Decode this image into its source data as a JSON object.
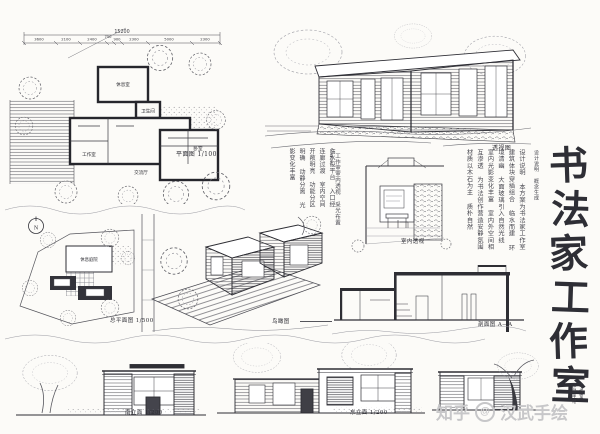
{
  "colors": {
    "paper": "#fcfbf8",
    "ink": "#2b2b30",
    "pencil": "#6b6b72",
    "watermark": "#c7c7c9"
  },
  "title": {
    "chars": [
      "书",
      "法",
      "家",
      "工",
      "作",
      "室"
    ],
    "side_note": "设计说明 概念生成",
    "seal_line1": "汉武手绘",
    "seal_line2": "工作室"
  },
  "plan": {
    "label": "平面图 1/100",
    "overall_dim": "15200",
    "dims": [
      "3600",
      "2100",
      "2400",
      "750",
      "900",
      "2300",
      "5000",
      "2300"
    ],
    "rooms": {
      "rest": "休息室",
      "bath": "卫生间",
      "studio": "工作室",
      "bed": "卧室",
      "tea": "交流厅"
    }
  },
  "perspective": {
    "label": "透视图"
  },
  "interior": {
    "label": "室内透视",
    "note": "工作室室内透视 采光布置得当"
  },
  "site": {
    "label": "总平面图 1/500",
    "north": "N",
    "court": "休息庭院"
  },
  "axon": {
    "label": "鸟瞰图"
  },
  "section": {
    "label": "剖面图 A—A"
  },
  "elevations": {
    "south": "南立面 1/200",
    "east": "东立面 1/200"
  },
  "notes": {
    "mid": "临水设平台 入口经连廊过渡 室内空间开敞明亮 功能分区明确 动静分离 光影变化丰富",
    "right": "设计说明 本方案为书法家工作室 建筑体块穿插组合 临水而建 环境清幽 大面玻璃引入自然光线 室内光影变化丰富 室内外空间相互渗透 为书法创作营造安静氛围 材质以木石为主 质朴自然"
  },
  "watermark": {
    "site": "知乎",
    "at": "@",
    "handle": "汉武手绘"
  }
}
